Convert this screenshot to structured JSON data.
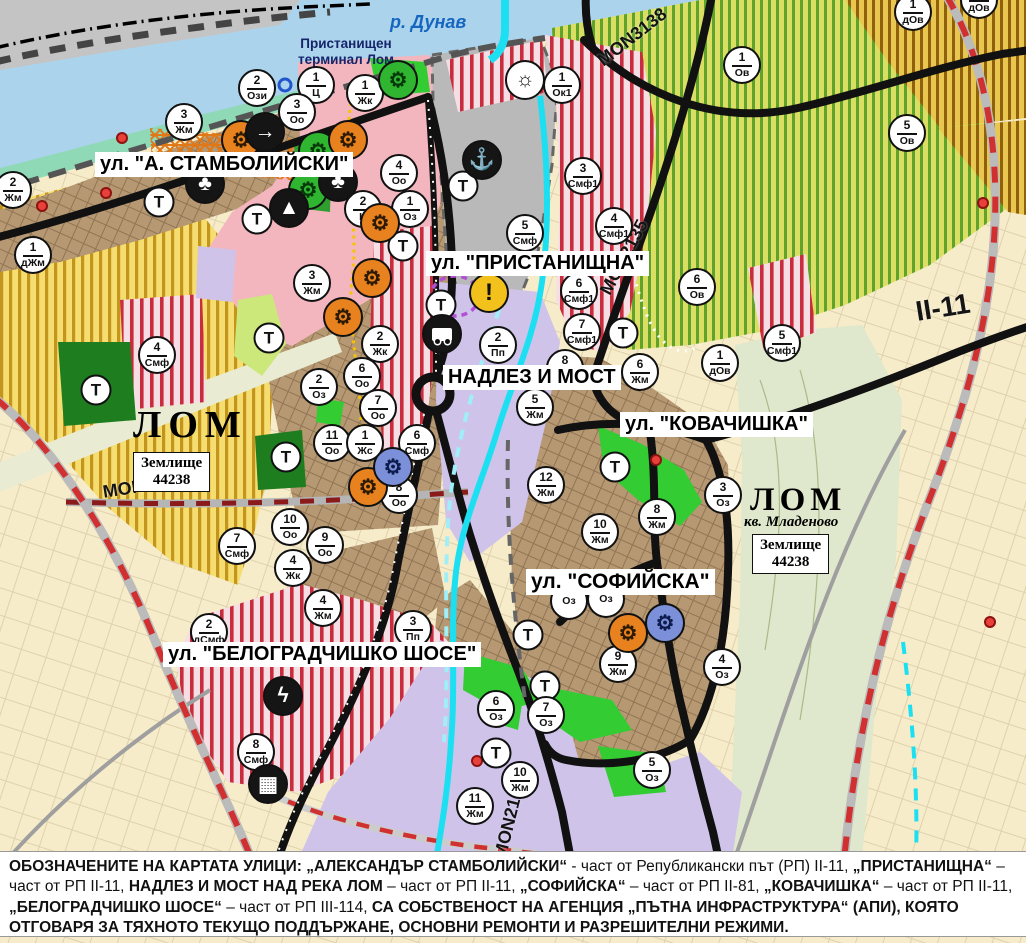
{
  "map": {
    "river_label": "р. Дунав",
    "port_label": {
      "line1": "Пристанищен",
      "line2": "терминал Лом"
    },
    "t_label": "Т",
    "street_labels": [
      {
        "text": "ул. \"А. СТАМБОЛИЙСКИ\"",
        "x": 95,
        "y": 152,
        "fs": 20
      },
      {
        "text": "ул. \"ПРИСТАНИЩНА\"",
        "x": 426,
        "y": 251,
        "fs": 20
      },
      {
        "text": "НАДЛЕЗ И МОСТ",
        "x": 443,
        "y": 365,
        "fs": 20
      },
      {
        "text": "ул. \"КОВАЧИШКА\"",
        "x": 620,
        "y": 412,
        "fs": 20
      },
      {
        "text": "ул. \"СОФИЙСКА\"",
        "x": 526,
        "y": 569,
        "fs": 21
      },
      {
        "text": "ул. \"БЕЛОГРАДЧИШКО ШОСЕ\"",
        "x": 163,
        "y": 642,
        "fs": 20
      }
    ],
    "road_labels": [
      {
        "text": "MON3139",
        "x": 103,
        "y": 482,
        "rot": -9,
        "fs": 18
      },
      {
        "text": "MON3138",
        "x": 600,
        "y": 52,
        "rot": -38,
        "fs": 18
      },
      {
        "text": "MON2135",
        "x": 605,
        "y": 283,
        "rot": -62,
        "fs": 18
      },
      {
        "text": "MON2136",
        "x": 500,
        "y": 848,
        "rot": -76,
        "fs": 18
      },
      {
        "text": "II-11",
        "x": 916,
        "y": 296,
        "rot": -9,
        "fs": 28
      }
    ],
    "city_labels": [
      {
        "text": "ЛОМ",
        "x": 133,
        "y": 403,
        "fs": 38,
        "ls": 7
      },
      {
        "text": "ЛОМ",
        "x": 750,
        "y": 482,
        "fs": 33,
        "ls": 5
      }
    ],
    "district_label": {
      "text": "кв. Младеново",
      "x": 744,
      "y": 514,
      "fs": 15
    },
    "land_boxes": [
      {
        "line1": "Землище",
        "line2": "44238",
        "x": 133,
        "y": 452
      },
      {
        "line1": "Землище",
        "line2": "44238",
        "x": 752,
        "y": 534
      }
    ],
    "markers": [
      {
        "n": "2",
        "c": "Ози",
        "x": 257,
        "y": 88
      },
      {
        "n": "1",
        "c": "Ц",
        "x": 316,
        "y": 85
      },
      {
        "n": "1",
        "c": "Жк",
        "x": 365,
        "y": 93
      },
      {
        "n": "1",
        "c": "Ок1",
        "x": 562,
        "y": 85
      },
      {
        "n": "1",
        "c": "Ов",
        "x": 742,
        "y": 65
      },
      {
        "n": "1",
        "c": "дОв",
        "x": 913,
        "y": 12
      },
      {
        "n": "1",
        "c": "дОв",
        "x": 979,
        "y": 0
      },
      {
        "n": "5",
        "c": "Ов",
        "x": 907,
        "y": 133
      },
      {
        "n": "3",
        "c": "Оо",
        "x": 297,
        "y": 112
      },
      {
        "n": "3",
        "c": "Жм",
        "x": 184,
        "y": 122
      },
      {
        "n": "2",
        "c": "Жм",
        "x": 13,
        "y": 190
      },
      {
        "n": "4",
        "c": "Оо",
        "x": 399,
        "y": 173
      },
      {
        "n": "1",
        "c": "дЖм",
        "x": 33,
        "y": 255
      },
      {
        "n": "2",
        "c": "Ц",
        "x": 363,
        "y": 209
      },
      {
        "n": "1",
        "c": "Оз",
        "x": 410,
        "y": 209
      },
      {
        "n": "3",
        "c": "Смф1",
        "x": 583,
        "y": 176
      },
      {
        "n": "4",
        "c": "Смф1",
        "x": 614,
        "y": 226
      },
      {
        "n": "5",
        "c": "Смф",
        "x": 525,
        "y": 233
      },
      {
        "n": "6",
        "c": "Ов",
        "x": 697,
        "y": 287
      },
      {
        "n": "6",
        "c": "Смф1",
        "x": 579,
        "y": 291
      },
      {
        "n": "7",
        "c": "Смф1",
        "x": 582,
        "y": 332
      },
      {
        "n": "5",
        "c": "Смф1",
        "x": 782,
        "y": 343
      },
      {
        "n": "1",
        "c": "дОв",
        "x": 720,
        "y": 363
      },
      {
        "n": "6",
        "c": "Жм",
        "x": 640,
        "y": 372
      },
      {
        "n": "2",
        "c": "Пп",
        "x": 498,
        "y": 345
      },
      {
        "n": "3",
        "c": "Жм",
        "x": 312,
        "y": 283
      },
      {
        "n": "2",
        "c": "Жк",
        "x": 380,
        "y": 344
      },
      {
        "n": "2",
        "c": "Оз",
        "x": 319,
        "y": 387
      },
      {
        "n": "6",
        "c": "Оо",
        "x": 362,
        "y": 376
      },
      {
        "n": "7",
        "c": "Оо",
        "x": 378,
        "y": 408
      },
      {
        "n": "11",
        "c": "Оо",
        "x": 332,
        "y": 443
      },
      {
        "n": "1",
        "c": "Жс",
        "x": 365,
        "y": 443
      },
      {
        "n": "6",
        "c": "Смф",
        "x": 417,
        "y": 443
      },
      {
        "n": "8",
        "c": "Оо",
        "x": 399,
        "y": 495
      },
      {
        "n": "8",
        "c": "Жм",
        "x": 565,
        "y": 368
      },
      {
        "n": "5",
        "c": "Жм",
        "x": 535,
        "y": 407
      },
      {
        "n": "12",
        "c": "Жм",
        "x": 546,
        "y": 485
      },
      {
        "n": "4",
        "c": "Смф",
        "x": 157,
        "y": 355
      },
      {
        "n": "7",
        "c": "Смф",
        "x": 237,
        "y": 546
      },
      {
        "n": "10",
        "c": "Оо",
        "x": 290,
        "y": 527
      },
      {
        "n": "9",
        "c": "Оо",
        "x": 325,
        "y": 545
      },
      {
        "n": "4",
        "c": "Жк",
        "x": 293,
        "y": 568
      },
      {
        "n": "10",
        "c": "Жм",
        "x": 600,
        "y": 532
      },
      {
        "n": "8",
        "c": "Жм",
        "x": 657,
        "y": 517
      },
      {
        "n": "3",
        "c": "Оз",
        "x": 723,
        "y": 495
      },
      {
        "n": "",
        "c": "Оз",
        "x": 569,
        "y": 601
      },
      {
        "n": "",
        "c": "Оз",
        "x": 606,
        "y": 599
      },
      {
        "n": "9",
        "c": "Жм",
        "x": 618,
        "y": 664
      },
      {
        "n": "4",
        "c": "Оз",
        "x": 722,
        "y": 667
      },
      {
        "n": "6",
        "c": "Оз",
        "x": 496,
        "y": 709
      },
      {
        "n": "7",
        "c": "Оз",
        "x": 546,
        "y": 715
      },
      {
        "n": "5",
        "c": "Оз",
        "x": 652,
        "y": 770
      },
      {
        "n": "10",
        "c": "Жм",
        "x": 520,
        "y": 780
      },
      {
        "n": "11",
        "c": "Жм",
        "x": 475,
        "y": 806
      },
      {
        "n": "2",
        "c": "дСмф",
        "x": 209,
        "y": 632
      },
      {
        "n": "3",
        "c": "Пп",
        "x": 413,
        "y": 629
      },
      {
        "n": "4",
        "c": "Жм",
        "x": 323,
        "y": 608
      },
      {
        "n": "8",
        "c": "Смф",
        "x": 256,
        "y": 752
      }
    ],
    "t_markers": [
      [
        159,
        202
      ],
      [
        257,
        219
      ],
      [
        463,
        186
      ],
      [
        403,
        246
      ],
      [
        441,
        305
      ],
      [
        269,
        338
      ],
      [
        96,
        390
      ],
      [
        286,
        457
      ],
      [
        623,
        333
      ],
      [
        615,
        467
      ],
      [
        528,
        635
      ],
      [
        545,
        686
      ],
      [
        496,
        753
      ]
    ],
    "icon_glyphs": {
      "machine": "⚙",
      "anchor": "⚓",
      "club": "♣",
      "arrow": "→",
      "mountain": "▲",
      "crane": "☼",
      "warning": "!",
      "bus": "",
      "lightning": "ϟ",
      "station": "▦",
      "ring": ""
    },
    "icons": [
      {
        "type": "machine",
        "color": "green",
        "x": 398,
        "y": 80
      },
      {
        "type": "machine",
        "color": "green",
        "x": 318,
        "y": 151
      },
      {
        "type": "machine",
        "color": "green",
        "x": 308,
        "y": 190
      },
      {
        "type": "machine",
        "color": "orange",
        "x": 241,
        "y": 140
      },
      {
        "type": "machine",
        "color": "orange",
        "x": 348,
        "y": 140
      },
      {
        "type": "machine",
        "color": "orange",
        "x": 380,
        "y": 223
      },
      {
        "type": "machine",
        "color": "orange",
        "x": 372,
        "y": 278
      },
      {
        "type": "machine",
        "color": "orange",
        "x": 343,
        "y": 317
      },
      {
        "type": "machine",
        "color": "orange",
        "x": 368,
        "y": 487
      },
      {
        "type": "machine",
        "color": "orange",
        "x": 628,
        "y": 633
      },
      {
        "type": "machine",
        "color": "blue",
        "x": 393,
        "y": 467
      },
      {
        "type": "machine",
        "color": "blue",
        "x": 665,
        "y": 623
      },
      {
        "type": "anchor",
        "color": "black",
        "x": 482,
        "y": 160
      },
      {
        "type": "club",
        "color": "black",
        "x": 338,
        "y": 182
      },
      {
        "type": "club",
        "color": "black",
        "x": 205,
        "y": 184
      },
      {
        "type": "arrow",
        "color": "black",
        "x": 265,
        "y": 132
      },
      {
        "type": "mountain",
        "color": "black",
        "x": 289,
        "y": 208
      },
      {
        "type": "crane",
        "color": "white",
        "x": 525,
        "y": 80
      },
      {
        "type": "warning",
        "color": "yellow",
        "x": 489,
        "y": 293
      },
      {
        "type": "bus",
        "color": "black",
        "x": 442,
        "y": 334
      },
      {
        "type": "lightning",
        "color": "black",
        "x": 283,
        "y": 696
      },
      {
        "type": "station",
        "color": "black",
        "x": 268,
        "y": 784
      },
      {
        "type": "ring",
        "color": "blue",
        "x": 285,
        "y": 85
      }
    ],
    "dots": [
      [
        122,
        138
      ],
      [
        106,
        193
      ],
      [
        42,
        206
      ],
      [
        656,
        460
      ],
      [
        983,
        203
      ],
      [
        477,
        761
      ],
      [
        990,
        622
      ]
    ]
  },
  "colors": {
    "water": "#abd4ec",
    "river_lom": "#1ce0f2",
    "residential_brown": "#b69872",
    "low_rise_yellow": "#f6dd6f",
    "orchard_green_stripe": "#5fa32d",
    "mixed_red_stripe": "#c92c3c",
    "industrial_lavender": "#cfc3ea",
    "central_pink": "#f3b6be",
    "port_gray": "#b9b9b9",
    "park_green": "#33cc33",
    "road_black": "#111111",
    "republic_road_red": "#d03030"
  },
  "note": {
    "segments": [
      {
        "text": "ОБОЗНАЧЕНИТЕ НА КАРТАТА УЛИЦИ: „АЛЕКСАНДЪР СТАМБОЛИЙСКИ“",
        "bold": true
      },
      {
        "text": " - част от Републикански път (РП) II-11, ",
        "bold": false
      },
      {
        "text": "„ПРИСТАНИЩНА“",
        "bold": true
      },
      {
        "text": " – част от РП II-11, ",
        "bold": false
      },
      {
        "text": "НАДЛЕЗ И МОСТ НАД РЕКА ЛОМ",
        "bold": true
      },
      {
        "text": " – част от РП II-11, ",
        "bold": false
      },
      {
        "text": "„СОФИЙСКА“",
        "bold": true
      },
      {
        "text": " – част от РП II-81, ",
        "bold": false
      },
      {
        "text": "„КОВАЧИШКА“",
        "bold": true
      },
      {
        "text": " – част от РП II-11, ",
        "bold": false
      },
      {
        "text": "„БЕЛОГРАДЧИШКО ШОСЕ“",
        "bold": true
      },
      {
        "text": " – част от РП III-114, ",
        "bold": false
      },
      {
        "text": "СА СОБСТВЕНОСТ НА АГЕНЦИЯ „ПЪТНА ИНФРАСТРУКТУРА“ (АПИ), КОЯТО ОТГОВАРЯ ЗА ТЯХНОТО ТЕКУЩО ПОДДЪРЖАНЕ, ОСНОВНИ РЕМОНТИ И РАЗРЕШИТЕЛНИ РЕЖИМИ.",
        "bold": true
      }
    ]
  }
}
